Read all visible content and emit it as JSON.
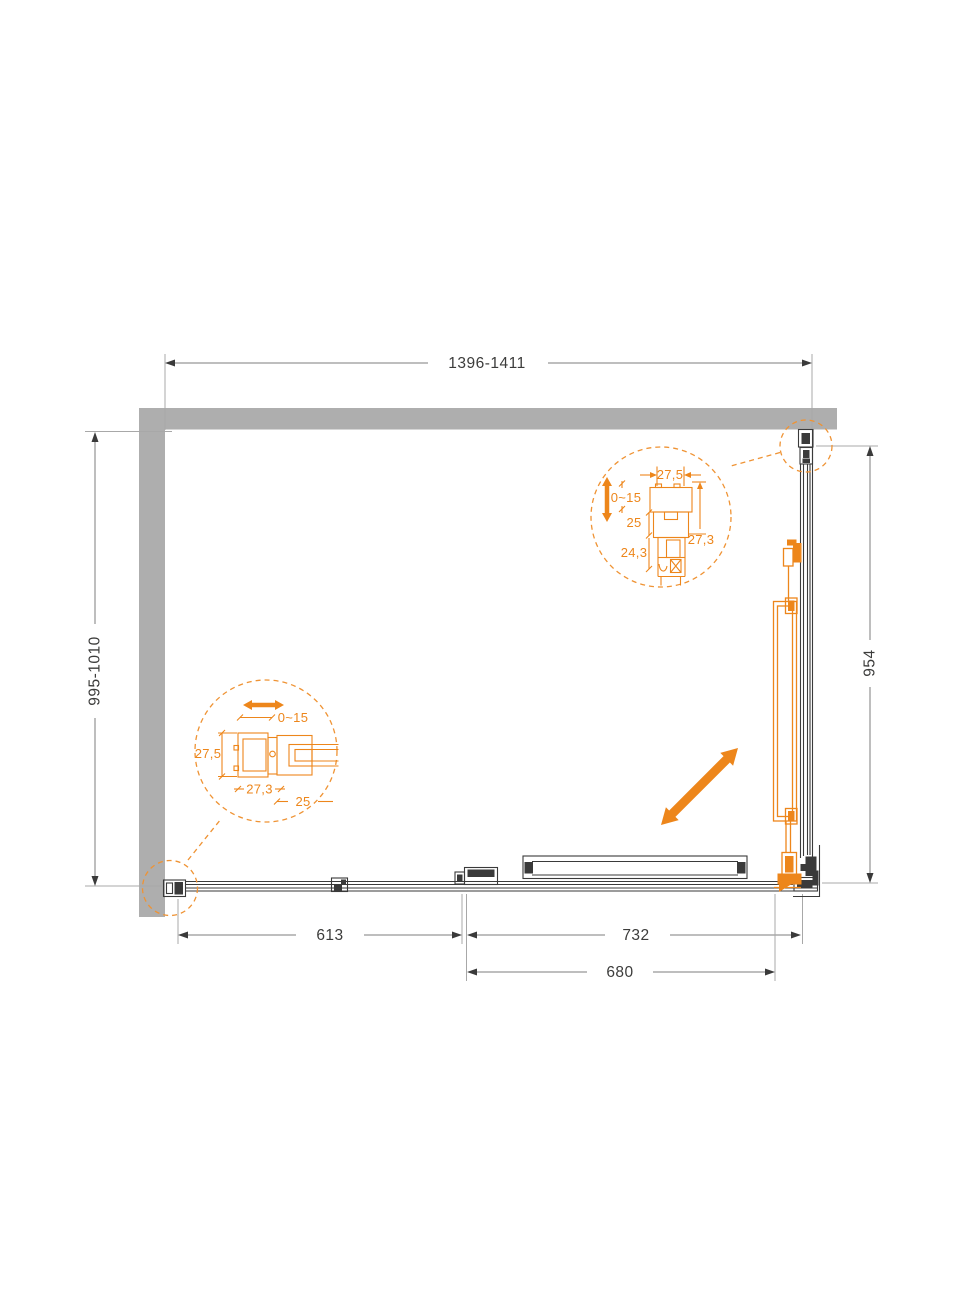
{
  "drawing": {
    "type": "shower-enclosure-plan-top-view",
    "colors": {
      "accent_orange": "#ED861B",
      "wall_gray": "#AEAEAE",
      "line_dark": "#3A3A3A",
      "dim_line_gray": "#7D7D7D",
      "text_dark": "#3C3C3B"
    }
  },
  "dimensions": {
    "top_width": "1396-1411",
    "left_depth": "995-1010",
    "right_height": "954",
    "bottom_fixed_panel": "613",
    "bottom_opening": "732",
    "bottom_door": "680"
  },
  "detail_wall_profile": {
    "adjustment": "0~15",
    "profile_depth": "27,5",
    "profile_width": "27,3",
    "rail_offset": "25"
  },
  "detail_top_profile": {
    "profile_width": "27,5",
    "adjustment": "0~15",
    "rail_depth": "25",
    "lower_depth": "24,3",
    "profile_height": "27,3"
  }
}
